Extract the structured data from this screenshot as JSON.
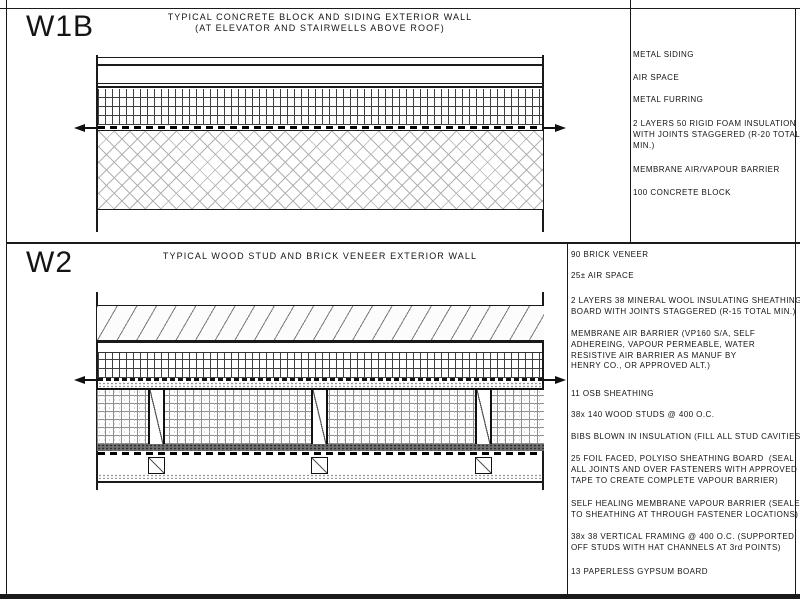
{
  "sheet": {
    "background": "#ffffff",
    "line_color": "#1a1a1a",
    "panels": [
      {
        "id": "W1B",
        "title_line1": "TYPICAL CONCRETE BLOCK AND SIDING EXTERIOR WALL",
        "title_line2": "(AT ELEVATOR AND STAIRWELLS ABOVE ROOF)",
        "labels": [
          "METAL SIDING",
          "AIR SPACE",
          "METAL FURRING",
          "2 LAYERS 50 RIGID FOAM INSULATION\nWITH JOINTS STAGGERED (R-20 TOTAL\nMIN.)",
          "MEMBRANE AIR/VAPOUR BARRIER",
          "100 CONCRETE BLOCK"
        ]
      },
      {
        "id": "W2",
        "title_line1": "TYPICAL WOOD STUD AND BRICK VENEER EXTERIOR WALL",
        "title_line2": "",
        "labels": [
          "90 BRICK VENEER",
          "25± AIR SPACE",
          "2 LAYERS 38 MINERAL WOOL INSULATING SHEATHING\nBOARD WITH JOINTS STAGGERED (R-15 TOTAL MIN.)",
          "MEMBRANE AIR BARRIER (VP160 S/A, SELF\nADHEREING, VAPOUR PERMEABLE, WATER\nRESISTIVE AIR BARRIER AS MANUF BY\nHENRY CO., OR APPROVED ALT.)",
          "11 OSB SHEATHING",
          "38x 140 WOOD STUDS @ 400 O.C.",
          "BIBS BLOWN IN INSULATION (FILL ALL STUD CAVITIES)",
          "25 FOIL FACED, POLYISO SHEATHING BOARD  (SEAL\nALL JOINTS AND OVER FASTENERS WITH APPROVED\nTAPE TO CREATE COMPLETE VAPOUR BARRIER)",
          "SELF HEALING MEMBRANE VAPOUR BARRIER (SEALED\nTO SHEATHING AT THROUGH FASTENER LOCATIONS)",
          "38x 38 VERTICAL FRAMING @ 400 O.C. (SUPPORTED\nOFF STUDS WITH HAT CHANNELS AT 3rd POINTS)",
          "13 PAPERLESS GYPSUM BOARD"
        ]
      }
    ]
  }
}
